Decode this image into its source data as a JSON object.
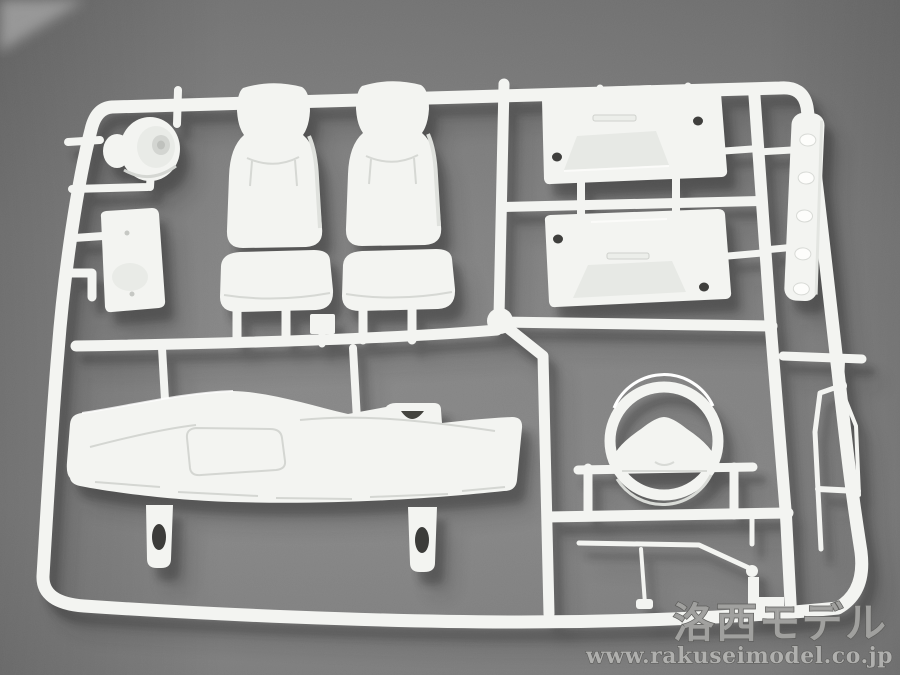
{
  "photo": {
    "subject": "white plastic model kit sprue (parts runner) on gray backdrop",
    "parts": [
      "hub-drum-part",
      "equipment-plate-part",
      "driver-seat-back",
      "passenger-seat-back",
      "driver-seat-cushion",
      "passenger-seat-cushion",
      "engine-cover-plate-upper",
      "engine-cover-plate-lower",
      "sill-strip-part",
      "dashboard-panel",
      "steering-wheel",
      "wiper-arm-rod",
      "lever-rod",
      "shift-lever",
      "mirror-stay-part",
      "sprue-gate"
    ],
    "colors": {
      "background": "#7b7b7b",
      "plastic": "#f3f4f1",
      "plastic_shade": "#d9dbd7",
      "hole_dark": "#3f3f3d",
      "watermark_fill": "#a6a6a4",
      "watermark_edge": "#5d5d5b"
    }
  },
  "watermark": {
    "title": "洛西モデル",
    "url": "www.rakuseimodel.co.jp"
  }
}
